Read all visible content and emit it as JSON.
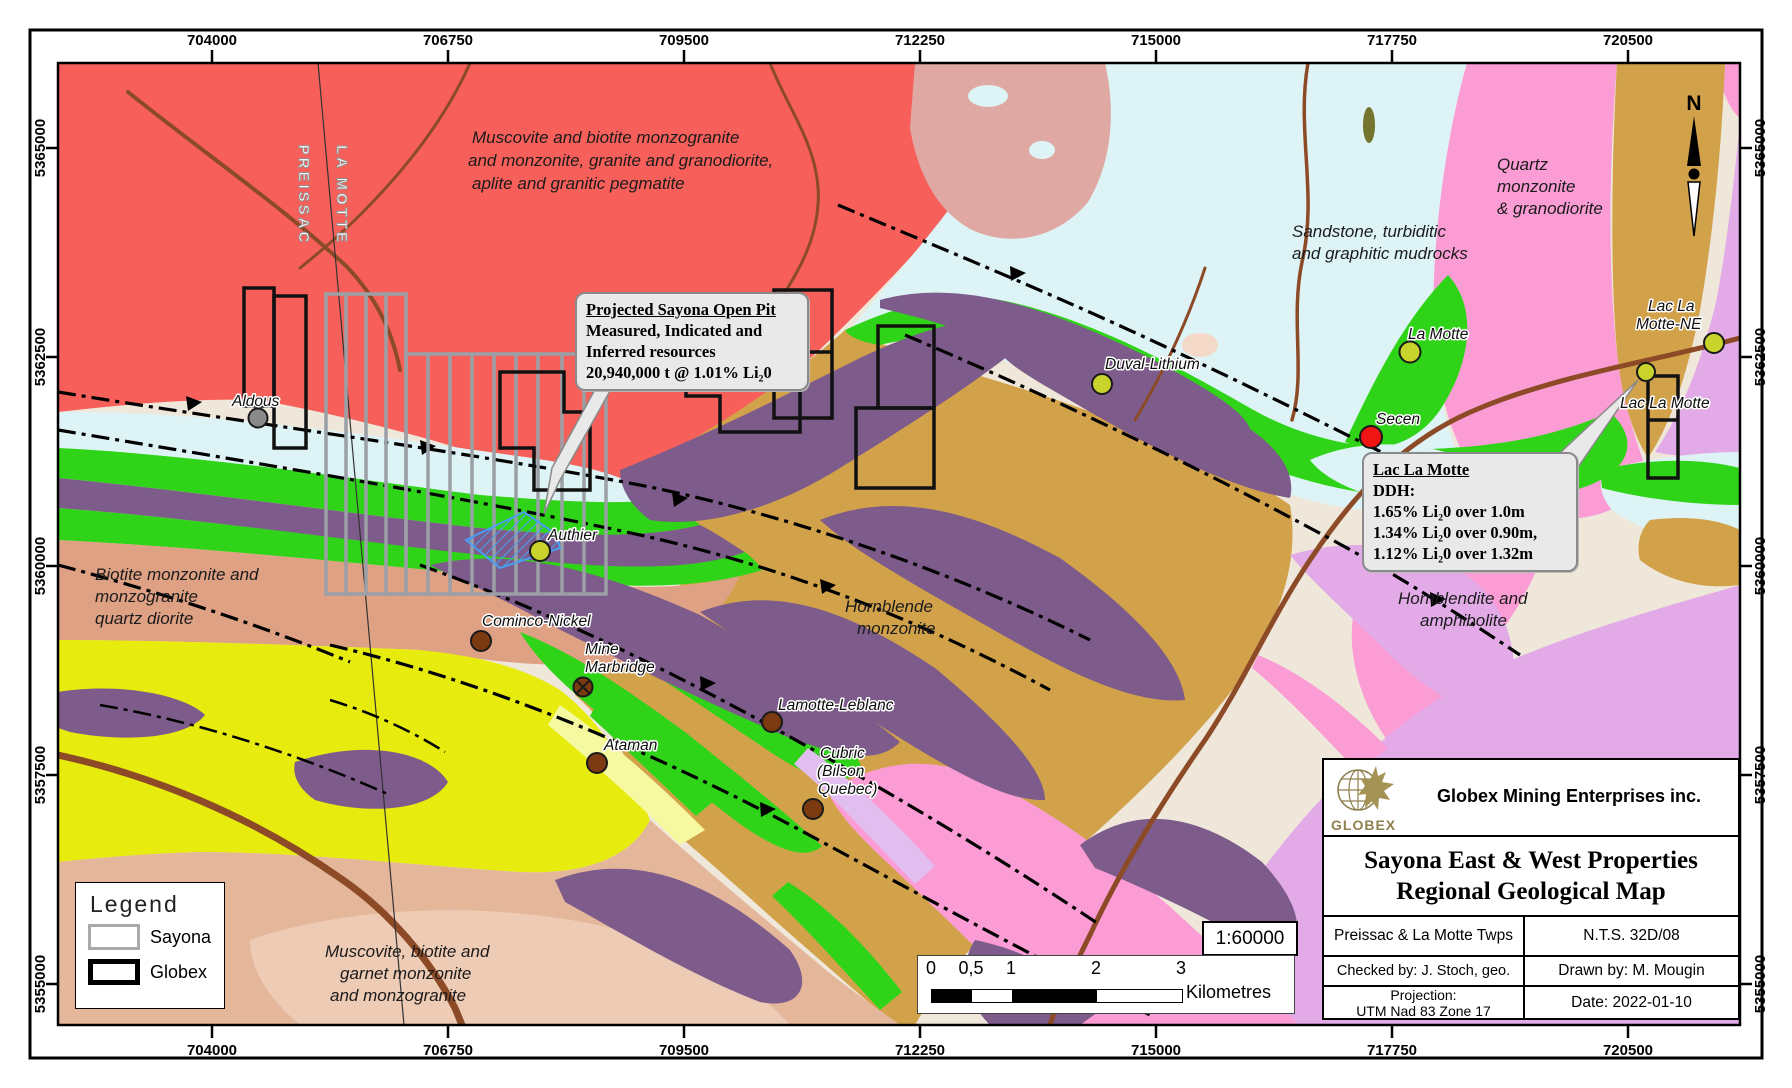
{
  "frame": {
    "top_ticks": [
      "704000",
      "706750",
      "709500",
      "712250",
      "715000",
      "717750",
      "720500"
    ],
    "side_ticks": [
      "5365000",
      "5362500",
      "5360000",
      "5357500",
      "5355000"
    ]
  },
  "map": {
    "townships": {
      "left": "PREISSAC",
      "right": "LA MOTTE"
    },
    "north_label": "N",
    "region_labels": [
      {
        "lines": [
          "Muscovite and biotite monzogranite",
          " and monzonite, granite and granodiorite,",
          "aplite and granitic pegmatite"
        ]
      },
      {
        "lines": [
          "Sandstone, turbiditic",
          "and graphitic mudrocks"
        ]
      },
      {
        "lines": [
          "Quartz",
          "monzonite",
          "& granodiorite"
        ]
      },
      {
        "lines": [
          "Biotite monzonite and",
          "monzogranite",
          "quartz diorite"
        ]
      },
      {
        "lines": [
          "Hornblende",
          "monzonite"
        ]
      },
      {
        "lines": [
          "Hornblendite and",
          "amphibolite"
        ]
      },
      {
        "lines": [
          "Muscovite, biotite and",
          "garnet monzonite",
          "and monzogranite"
        ]
      }
    ],
    "occurrences": [
      {
        "lines": [
          "Aldous"
        ]
      },
      {
        "lines": [
          "Authier"
        ]
      },
      {
        "lines": [
          "Duval-Lithium"
        ]
      },
      {
        "lines": [
          "La Motte"
        ]
      },
      {
        "lines": [
          "Lac La",
          "Motte-NE"
        ]
      },
      {
        "lines": [
          "Lac La Motte"
        ]
      },
      {
        "lines": [
          "Secen"
        ]
      },
      {
        "lines": [
          "Cominco-Nickel"
        ]
      },
      {
        "lines": [
          "Mine",
          "Marbridge"
        ]
      },
      {
        "lines": [
          "Ataman"
        ]
      },
      {
        "lines": [
          "Lamotte-Leblanc"
        ]
      },
      {
        "lines": [
          "Cubric",
          "(Bilson",
          "Quebec)"
        ]
      }
    ],
    "callouts": {
      "open_pit": {
        "title": "Projected Sayona Open Pit",
        "lines": [
          "Measured, Indicated and",
          "Inferred resources",
          "20,940,000 t @ 1.01% Li₂0"
        ]
      },
      "lac_la_motte": {
        "title": "Lac La Motte",
        "lines": [
          "DDH:",
          "1.65% Li₂0 over 1.0m",
          "1.34% Li₂0 over 0.90m,",
          "1.12% Li₂0 over 1.32m"
        ]
      }
    }
  },
  "legend": {
    "title": "Legend",
    "items": [
      {
        "label": "Sayona"
      },
      {
        "label": "Globex"
      }
    ]
  },
  "scalebar": {
    "ratio": "1:60000",
    "ticks": [
      "0",
      "0,5",
      "1",
      "2",
      "3"
    ],
    "unit": "Kilometres"
  },
  "title_block": {
    "company": "Globex Mining Enterprises inc.",
    "logo_text": "GLOBEX",
    "title_line1": "Sayona East & West Properties",
    "title_line2": "Regional Geological Map",
    "townships": "Preissac & La Motte Twps",
    "nts": "N.T.S. 32D/08",
    "checked_by": "Checked by: J. Stoch, geo.",
    "drawn_by": "Drawn by: M. Mougin",
    "projection_label": "Projection:",
    "projection_value": "UTM Nad 83 Zone 17",
    "date": "Date: 2022-01-10"
  },
  "colors": {
    "granite_red": "#f7605a",
    "mudrocks_cyan": "#ddf3f5",
    "quartz_monzonite_pink": "#fb9cd4",
    "hornblende_tan": "#d2a24b",
    "amphibolite_purple": "#7d5b8a",
    "pegmatite_green": "#2fd418",
    "yellow_unit": "#e7ec0e",
    "monzonite_salmon": "#dfa184",
    "hornblendite_lilac": "#e2abe8",
    "river_brown": "#8c4a27",
    "sayona_gray": "#9aa0a6",
    "globex_black": "#111111",
    "lithium_dot": "#c9d32c",
    "occurrence_brown": "#7b3a10",
    "highlight_red": "#f01414"
  }
}
